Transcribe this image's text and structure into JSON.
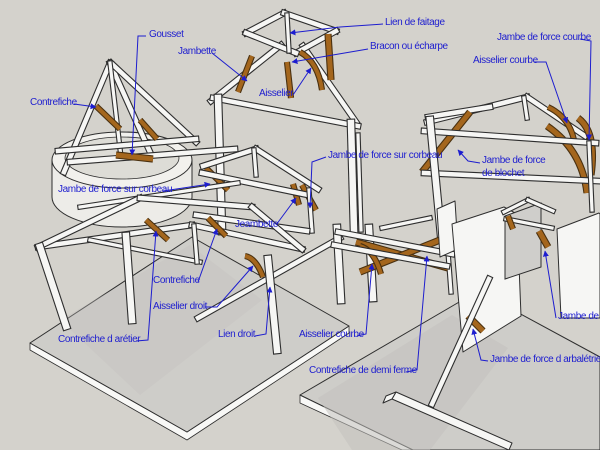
{
  "palette": {
    "background": "#d4d2cc",
    "label_blue": "#1d1dcf",
    "wood": "#a4661d",
    "wood_outline": "#4a3110",
    "beam_white": "#f6f6f4",
    "beam_outline": "#2e2e2e",
    "platform_top": "#cecdc9",
    "platform_side": "#f8f8f6",
    "shadow": "#c2c1bd"
  },
  "labels": [
    {
      "id": "gousset",
      "text": "Gousset"
    },
    {
      "id": "jambette",
      "text": "Jambette"
    },
    {
      "id": "contrefiche-haut",
      "text": "Contrefiche"
    },
    {
      "id": "aisselier",
      "text": "Aisselier"
    },
    {
      "id": "lien-de-faitage",
      "text": "Lien de faitage"
    },
    {
      "id": "bracon-ou-echarpe",
      "text": "Bracon ou écharpe"
    },
    {
      "id": "jambe-de-force-courbe",
      "text": "Jambe de force courbe"
    },
    {
      "id": "aisselier-courbe-haut",
      "text": "Aisselier courbe"
    },
    {
      "id": "jambe-de-force-sur-corbeau-centre",
      "text": "Jambe de force sur corbeau"
    },
    {
      "id": "jambe-de-force-sur-corbeau-gauche",
      "text": "Jambe de force sur corbeau"
    },
    {
      "id": "jambe-de-force-de-blochet-ligne1",
      "text": "Jambe de force"
    },
    {
      "id": "jambe-de-force-de-blochet-ligne2",
      "text": "de blochet"
    },
    {
      "id": "jeambette",
      "text": "Jeambette"
    },
    {
      "id": "contrefiche-milieu",
      "text": "Contrefiche"
    },
    {
      "id": "aisselier-droit",
      "text": "Aisselier droit"
    },
    {
      "id": "contrefiche-d-aretier",
      "text": "Contrefiche d arétier"
    },
    {
      "id": "lien-droit",
      "text": "Lien droit"
    },
    {
      "id": "aisselier-courbe-bas",
      "text": "Aisselier courbe"
    },
    {
      "id": "contrefiche-de-demi-ferme",
      "text": "Contrefiche de demi ferme"
    },
    {
      "id": "jambe-de-force-d-arbaletrier",
      "text": "Jambe de force d arbalétrier"
    },
    {
      "id": "jambe-de-force-tronque",
      "text": "Jambe de fo"
    }
  ]
}
